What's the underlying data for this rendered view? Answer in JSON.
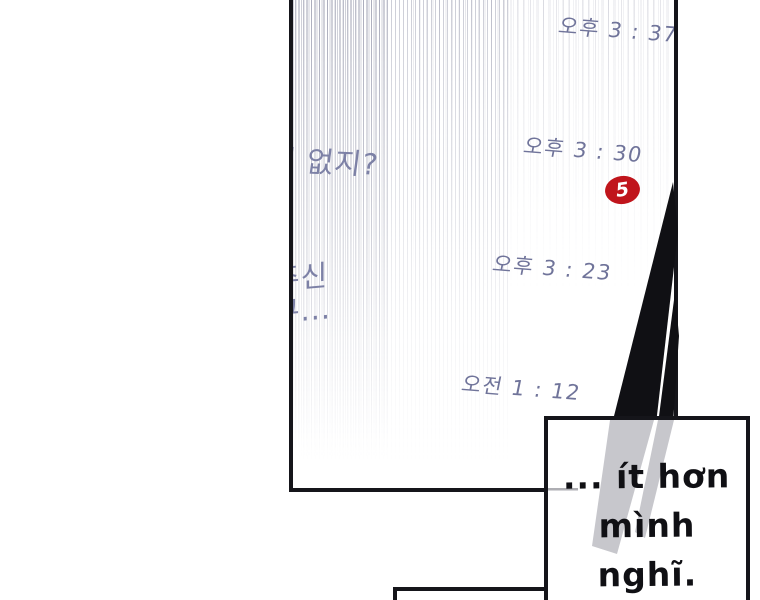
{
  "chat_screen": {
    "timestamps": [
      "오후 3 : 37",
      "오후 3 : 30",
      "오후 3 : 23",
      "오전 1 : 12"
    ],
    "unread_badge_count": "5",
    "message_fragments": {
      "bubble1": "이 없지?",
      "bubble2_line1": "주신",
      "bubble2_line2": "쿠..."
    }
  },
  "caption_box": {
    "line1": "... ít hơn",
    "line2": "mình nghĩ."
  },
  "colors": {
    "chat_text_purple": "#70749a",
    "message_purple": "#7d81a6",
    "badge_red": "#c0151c",
    "ink_black": "#15151a",
    "tone_gray": "#c7c7cc"
  }
}
